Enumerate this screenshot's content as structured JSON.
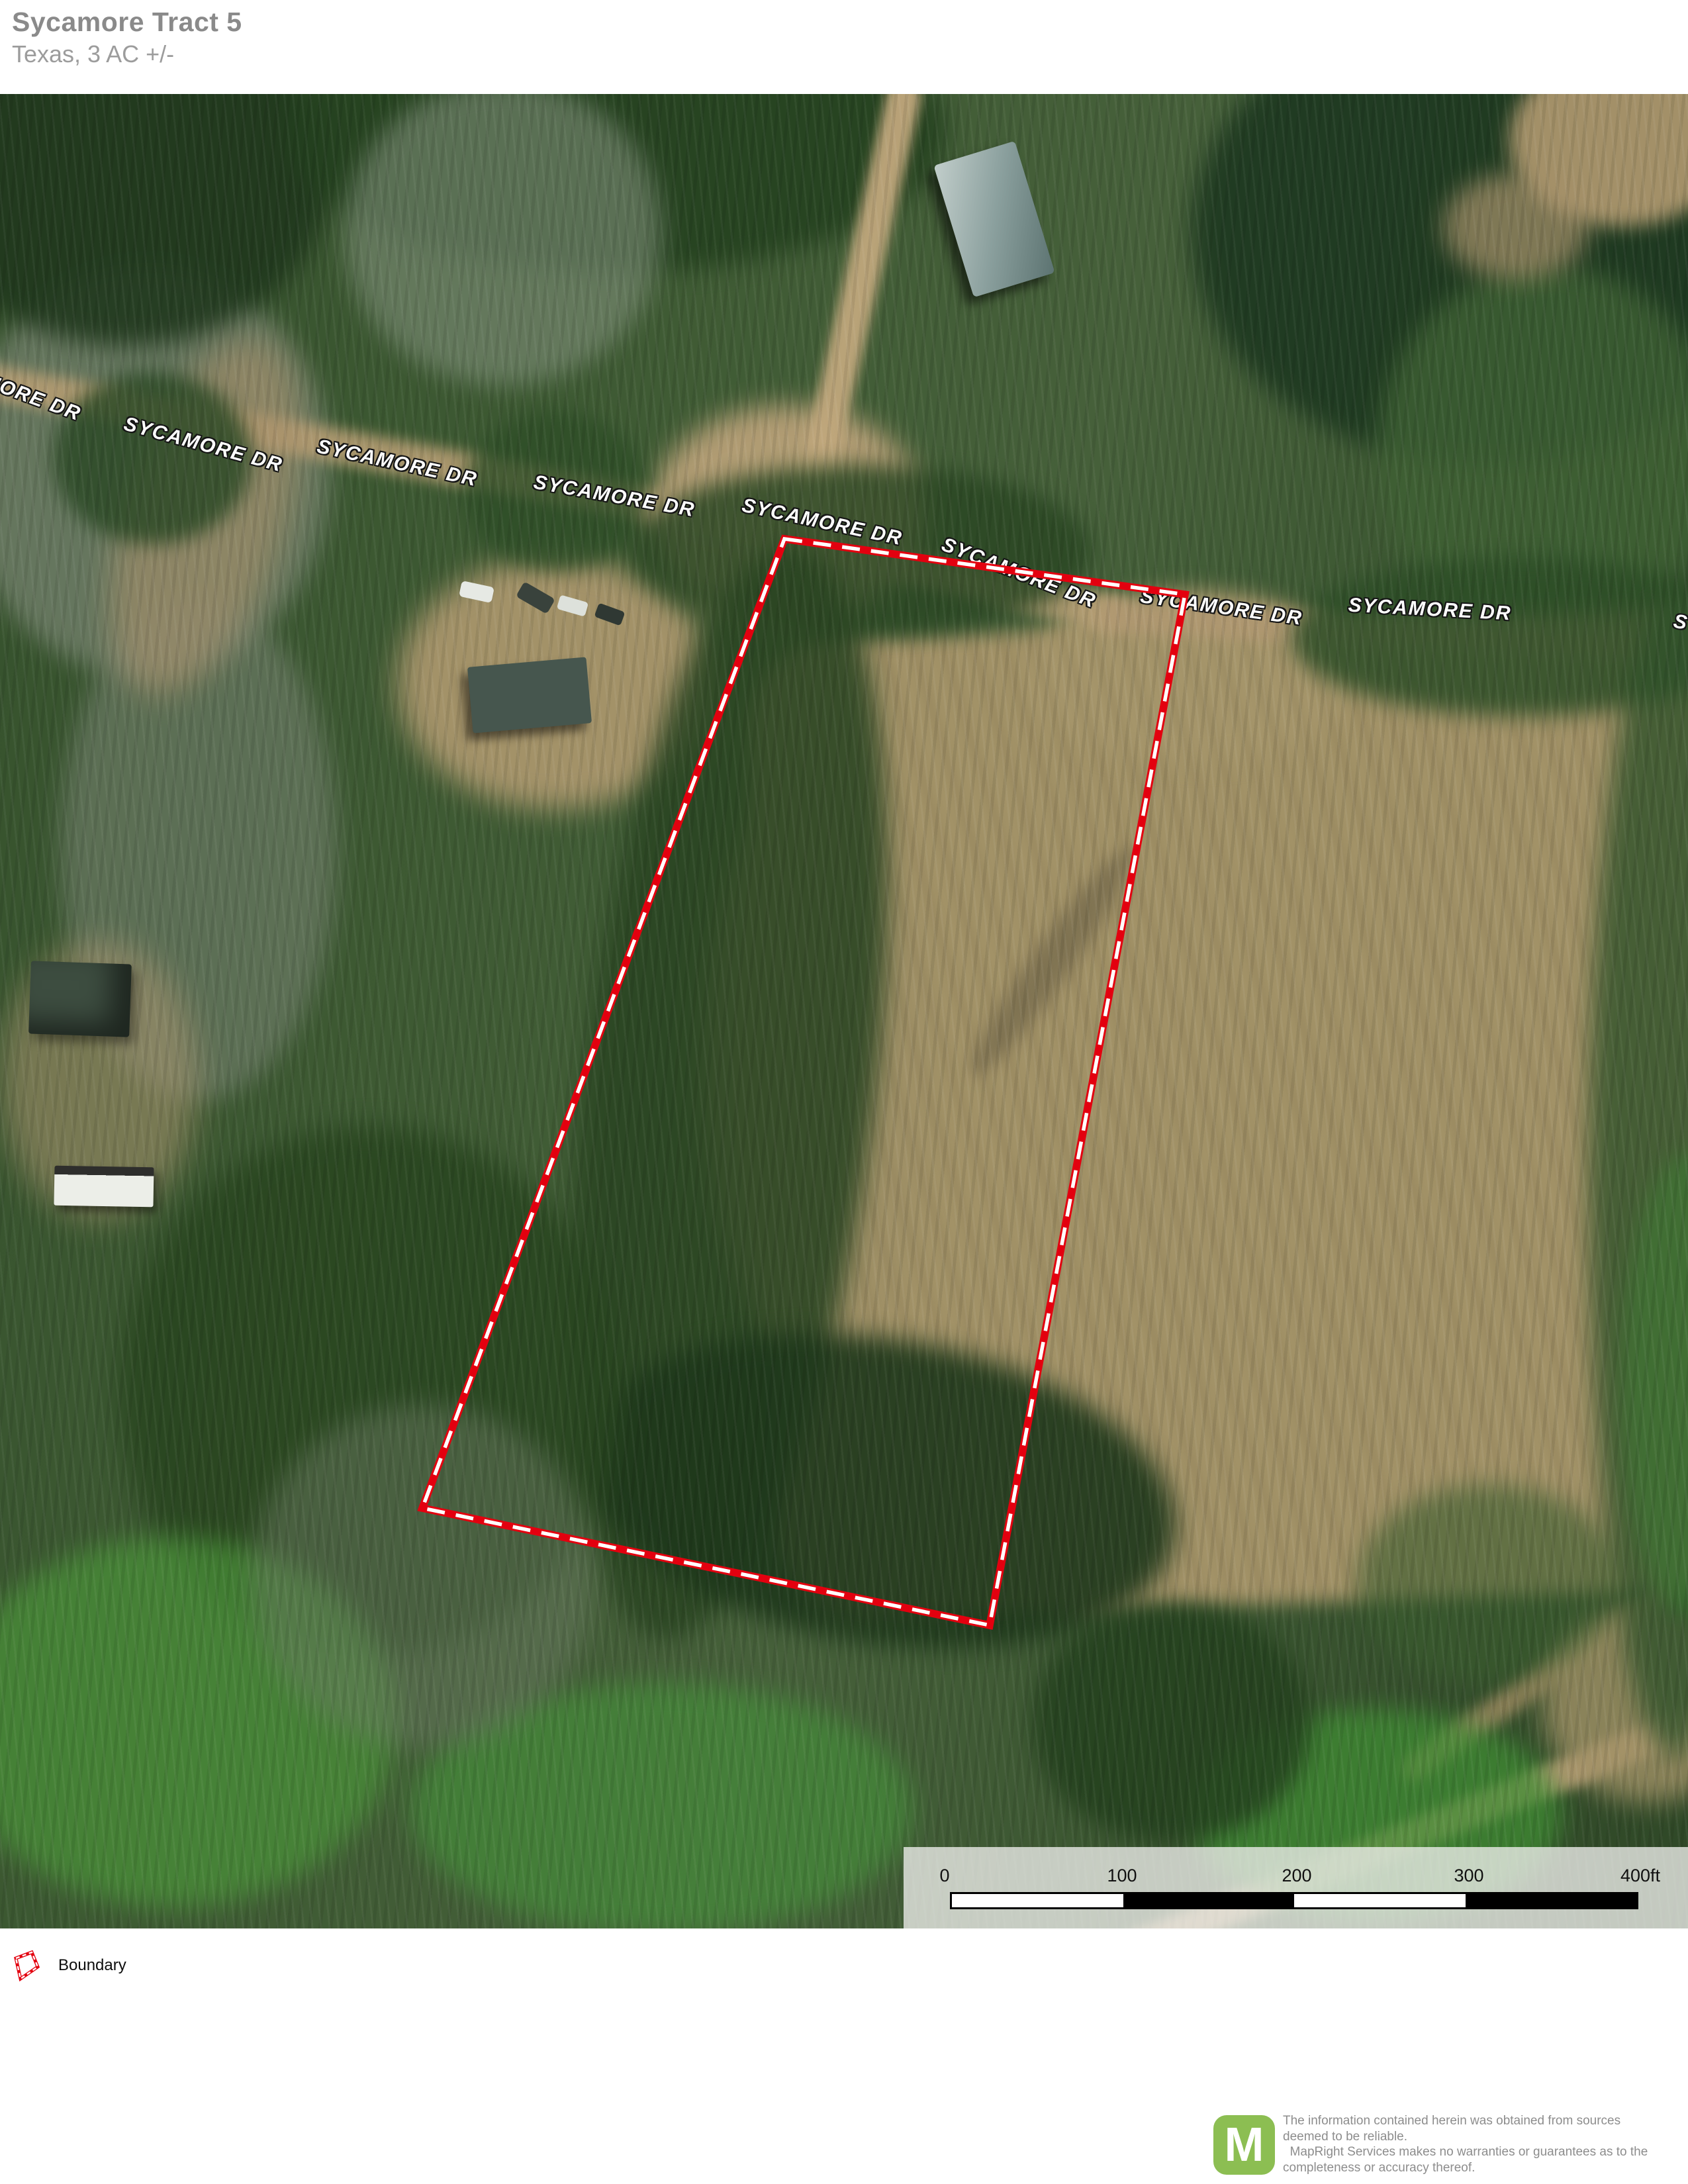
{
  "header": {
    "title": "Sycamore Tract 5",
    "subtitle": "Texas, 3 AC +/-"
  },
  "map": {
    "road_labels": [
      {
        "text": "SYCAMORE DR"
      },
      {
        "text": "SYCAMORE DR"
      },
      {
        "text": "SYCAMORE DR"
      },
      {
        "text": "SYCAMORE DR"
      },
      {
        "text": "SYCAMORE DR"
      },
      {
        "text": "SYCAMORE DR"
      },
      {
        "text": "SYCAMORE DR"
      },
      {
        "text": "SYCAMORE DR"
      },
      {
        "text": "SYCAMORE DR"
      }
    ]
  },
  "scale_bar": {
    "labels": [
      "0",
      "100",
      "200",
      "300",
      "400ft"
    ]
  },
  "legend": {
    "items": [
      {
        "label": "Boundary"
      }
    ]
  },
  "footer": {
    "logo_letter": "M",
    "disclaimer_lines": [
      "The information contained herein was obtained from sources",
      "deemed to be reliable.",
      "  MapRight Services makes no warranties or guarantees as to the",
      "completeness or accuracy thereof."
    ]
  },
  "colors": {
    "boundary_red": "#e3000f",
    "logo_green": "#8cbe52",
    "title_gray": "#8a8a8a",
    "subtitle_gray": "#9c9c9c",
    "disclaimer_gray": "#8d8d8d"
  }
}
